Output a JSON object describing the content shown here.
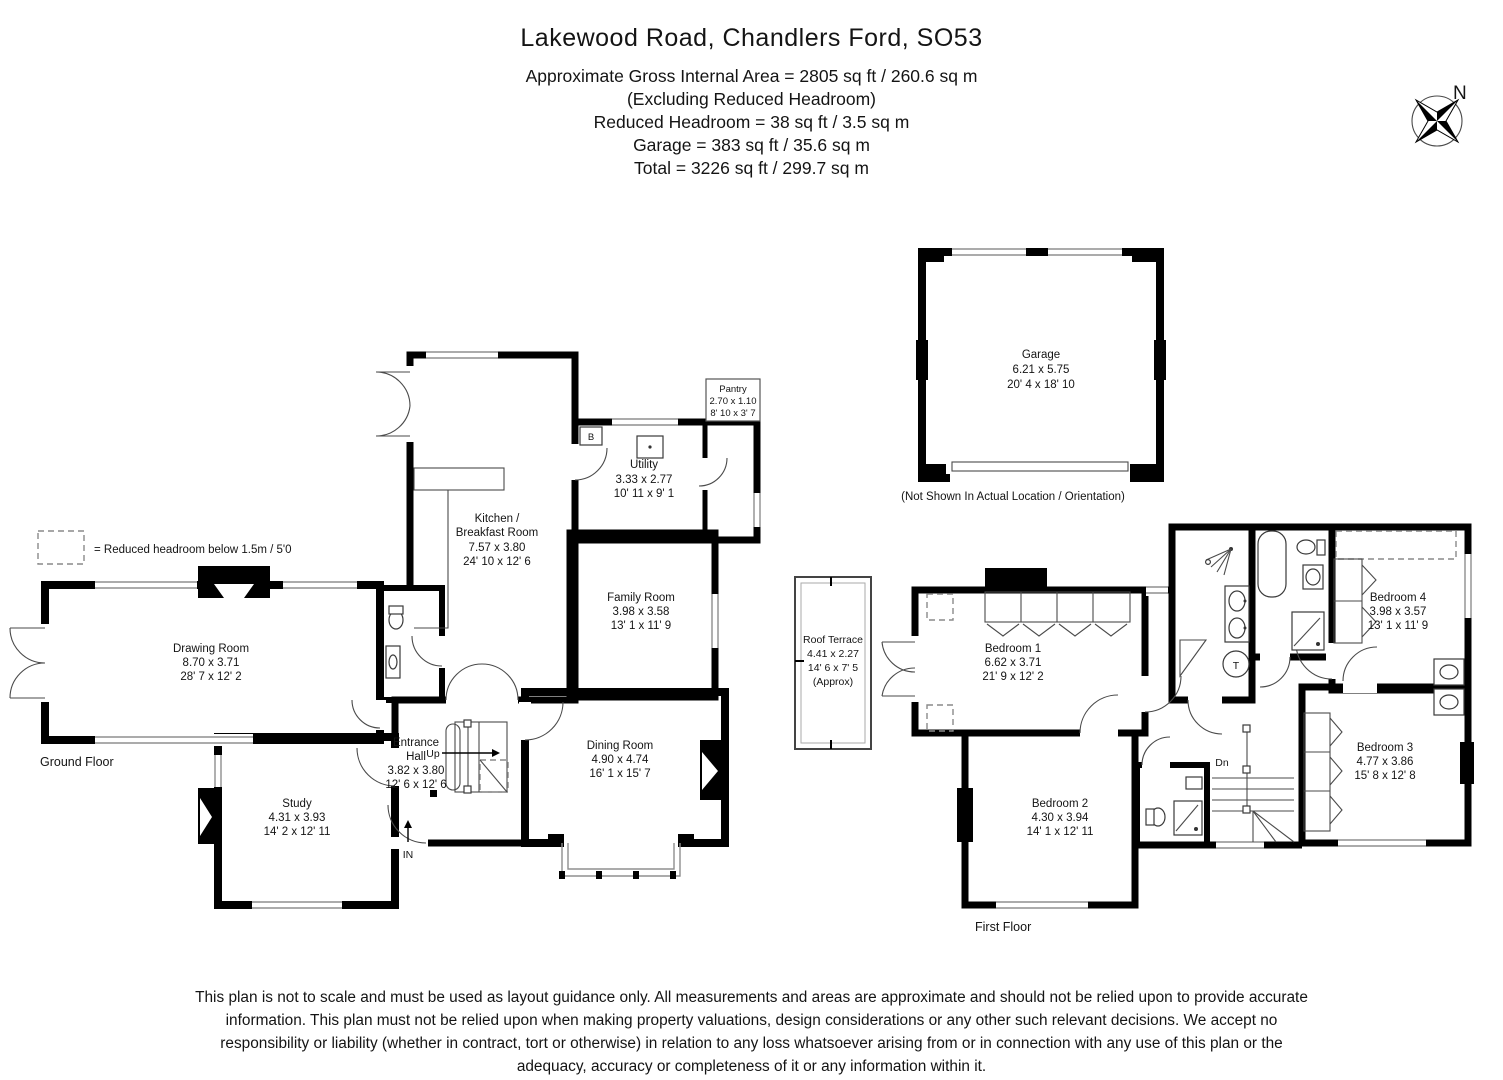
{
  "header": {
    "title": "Lakewood Road, Chandlers Ford, SO53",
    "area": "Approximate Gross Internal Area = 2805 sq ft / 260.6 sq m",
    "excluding": "(Excluding Reduced Headroom)",
    "reduced": "Reduced Headroom = 38 sq ft / 3.5 sq m",
    "garage": "Garage = 383 sq ft / 35.6 sq m",
    "total": "Total = 3226 sq ft / 299.7 sq m"
  },
  "legend": {
    "text": "= Reduced headroom below 1.5m / 5'0"
  },
  "floors": {
    "ground": "Ground Floor",
    "first": "First Floor"
  },
  "garage": {
    "note": "(Not Shown In Actual Location / Orientation)"
  },
  "rooms": {
    "kitchen": {
      "name1": "Kitchen /",
      "name2": "Breakfast Room",
      "metric": "7.57 x 3.80",
      "imperial": "24' 10 x 12' 6"
    },
    "utility": {
      "name": "Utility",
      "metric": "3.33 x 2.77",
      "imperial": "10' 11 x 9' 1"
    },
    "pantry": {
      "name": "Pantry",
      "metric": "2.70 x 1.10",
      "imperial": "8' 10 x 3' 7"
    },
    "family": {
      "name": "Family Room",
      "metric": "3.98 x 3.58",
      "imperial": "13' 1 x 11' 9"
    },
    "drawing": {
      "name": "Drawing Room",
      "metric": "8.70 x 3.71",
      "imperial": "28' 7 x 12' 2"
    },
    "study": {
      "name": "Study",
      "metric": "4.31 x 3.93",
      "imperial": "14' 2 x 12' 11"
    },
    "entrance": {
      "name1": "Entrance",
      "name2": "Hall",
      "metric": "3.82 x 3.80",
      "imperial": "12' 6 x 12' 6"
    },
    "dining": {
      "name": "Dining Room",
      "metric": "4.90 x 4.74",
      "imperial": "16' 1 x 15' 7"
    },
    "terrace": {
      "name": "Roof Terrace",
      "metric": "4.41 x 2.27",
      "imperial": "14' 6 x 7' 5",
      "approx": "(Approx)"
    },
    "bed1": {
      "name": "Bedroom 1",
      "metric": "6.62 x 3.71",
      "imperial": "21' 9 x 12' 2"
    },
    "bed2": {
      "name": "Bedroom 2",
      "metric": "4.30 x 3.94",
      "imperial": "14' 1 x 12' 11"
    },
    "bed3": {
      "name": "Bedroom 3",
      "metric": "4.77 x 3.86",
      "imperial": "15' 8 x 12' 8"
    },
    "bed4": {
      "name": "Bedroom 4",
      "metric": "3.98 x 3.57",
      "imperial": "13' 1 x 11' 9"
    },
    "garage": {
      "name": "Garage",
      "metric": "6.21 x 5.75",
      "imperial": "20' 4 x 18' 10"
    }
  },
  "markers": {
    "up": "Up",
    "dn": "Dn",
    "in": "IN",
    "boiler": "B",
    "tank": "T",
    "north": "N"
  },
  "disclaimer": {
    "text": "This plan is not to scale and must be used as layout guidance only. All measurements and areas are approximate and should not be relied upon to provide accurate information. This plan must not be relied upon when making property valuations, design considerations or any other such relevant decisions. We accept no responsibility or liability (whether in contract, tort or otherwise) in relation to any loss whatsoever arising from or in connection with any use of this plan or the adequacy, accuracy or completeness of it or any information within it."
  }
}
